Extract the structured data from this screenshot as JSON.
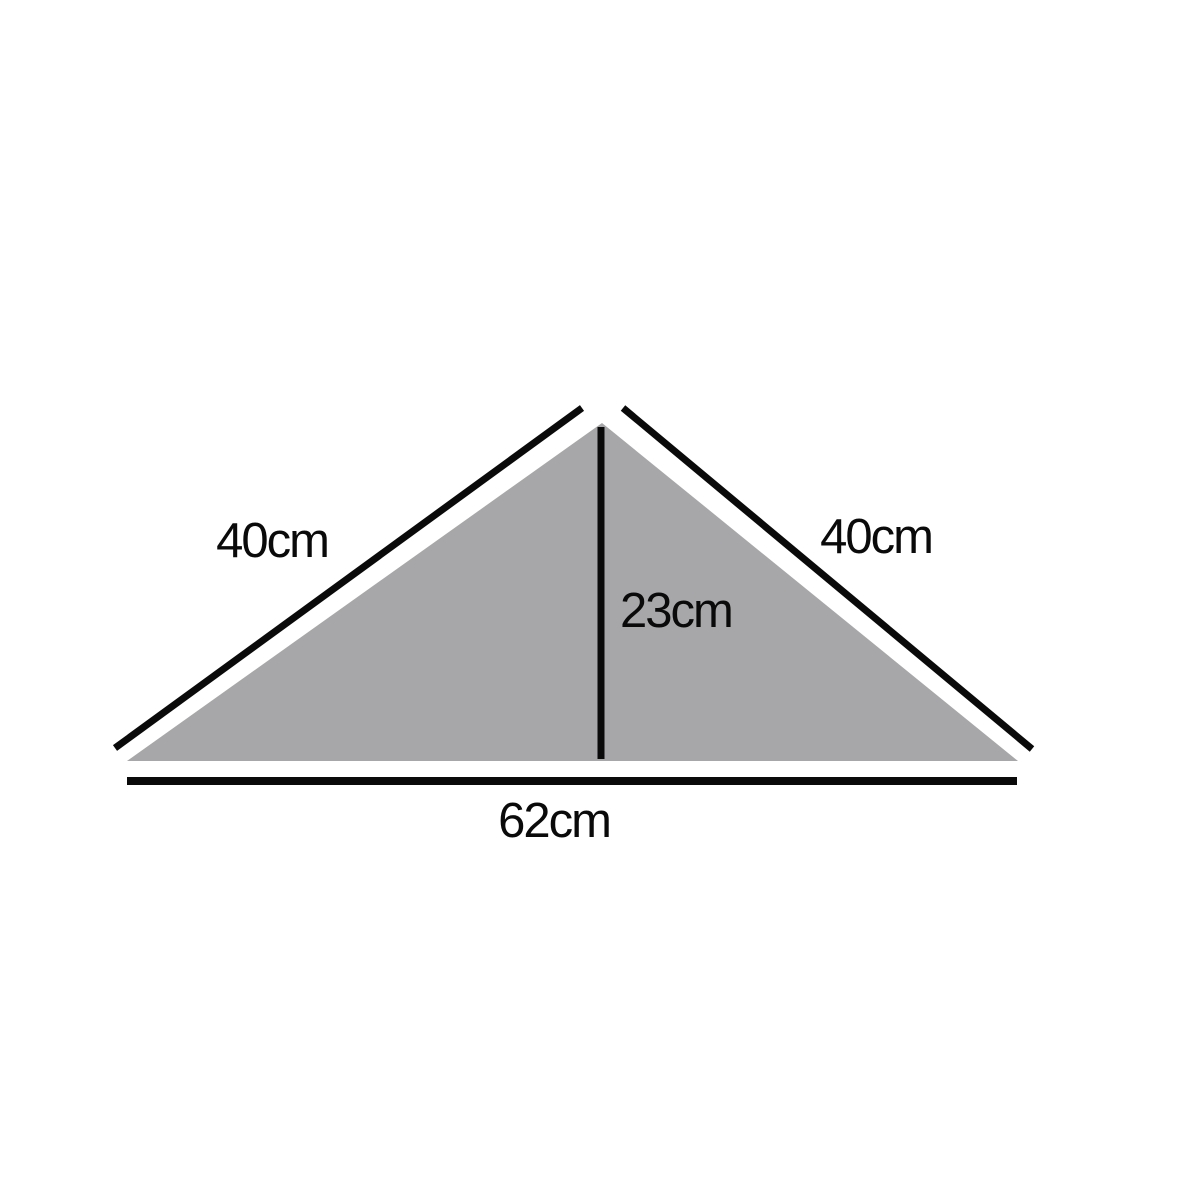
{
  "diagram": {
    "type": "geometry-figure",
    "shape": "isosceles-triangle",
    "background_color": "#ffffff",
    "line_color": "#0a0a0a",
    "triangle": {
      "fill_color": "#a7a7a9"
    },
    "labels": {
      "left_side": "40cm",
      "right_side": "40cm",
      "height": "23cm",
      "base": "62cm"
    },
    "measurements": {
      "left_side_cm": 40,
      "right_side_cm": 40,
      "height_cm": 23,
      "base_cm": 62,
      "unit": "cm"
    }
  }
}
